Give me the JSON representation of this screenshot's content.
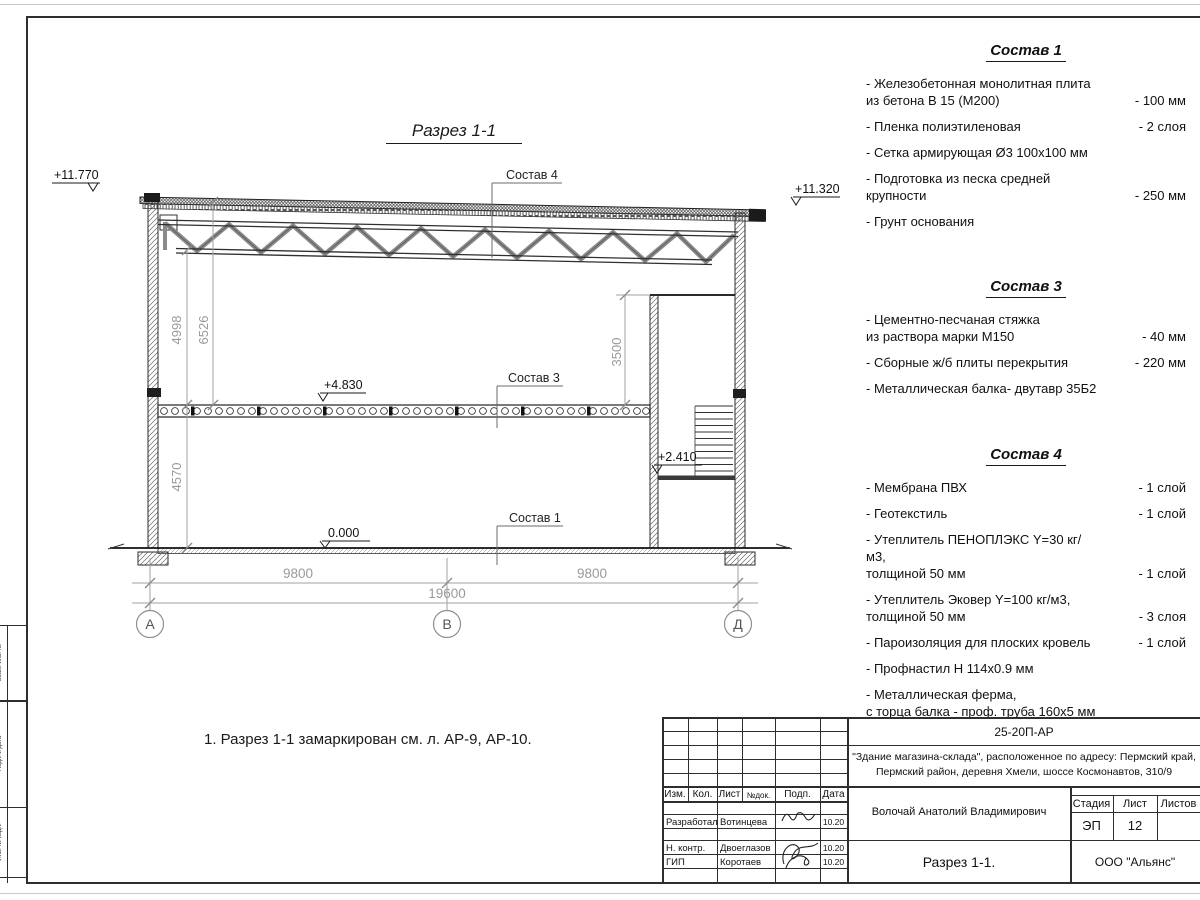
{
  "drawing": {
    "title": "Разрез 1-1",
    "note": "1. Разрез 1-1 замаркирован см. л. АР-9, АР-10.",
    "elevations": {
      "roof_left": "+11.770",
      "roof_right": "+11.320",
      "floor2": "+4.830",
      "ground": "0.000",
      "landing": "+2.410"
    },
    "dims": {
      "truss_clear": "4998",
      "roof_clear": "6526",
      "ground_clear": "4570",
      "room_height": "3500",
      "span_left": "9800",
      "span_right": "9800",
      "span_total": "19600"
    },
    "axes": {
      "a": "А",
      "b": "В",
      "d": "Д"
    },
    "layer_refs": {
      "r4": "Состав 4",
      "r3": "Состав 3",
      "r1": "Состав 1"
    }
  },
  "comp1": {
    "title": "Состав 1",
    "items": [
      {
        "name": "- Железобетонная  монолитная плита\n  из бетона В 15 (М200)",
        "value": "- 100 мм"
      },
      {
        "name": "- Пленка полиэтиленовая",
        "value": "-  2 слоя"
      },
      {
        "name": "- Сетка армирующая Ø3 100х100 мм",
        "value": ""
      },
      {
        "name": "- Подготовка из песка средней\n  крупности",
        "value": "- 250 мм"
      },
      {
        "name": "- Грунт основания",
        "value": ""
      }
    ]
  },
  "comp3": {
    "title": "Состав 3",
    "items": [
      {
        "name": "- Цементно-песчаная стяжка\n  из раствора марки М150",
        "value": "- 40 мм"
      },
      {
        "name": "- Сборные ж/б плиты перекрытия",
        "value": "- 220 мм"
      },
      {
        "name": "- Металлическая балка- двутавр 35Б2",
        "value": ""
      }
    ]
  },
  "comp4": {
    "title": "Состав 4",
    "items": [
      {
        "name": "- Мембрана ПВХ",
        "value": "- 1 слой"
      },
      {
        "name": "- Геотекстиль",
        "value": "- 1 слой"
      },
      {
        "name": "- Утеплитель ПЕНОПЛЭКС Y=30 кг/м3,\n  толщиной 50 мм",
        "value": "- 1 слой"
      },
      {
        "name": "- Утеплитель Эковер Y=100 кг/м3,\n  толщиной 50 мм",
        "value": "- 3 слоя"
      },
      {
        "name": "- Пароизоляция для плоских кровель",
        "value": "- 1 слой"
      },
      {
        "name": "- Профнастил Н 114х0.9 мм",
        "value": ""
      },
      {
        "name": "- Металлическая ферма,\n  с торца балка - проф. труба 160х5 мм",
        "value": ""
      }
    ]
  },
  "titleblock": {
    "code": "25-20П-АР",
    "project_line1": "\"Здание магазина-склада\", расположенное по адресу: Пермский край,",
    "project_line2": "Пермский район, деревня Хмели, шоссе Космонавтов, 310/9",
    "cols": {
      "izm": "Изм.",
      "kol": "Кол.",
      "list": "Лист",
      "ndok": "№док.",
      "podp": "Подп.",
      "data": "Дата"
    },
    "rows": [
      {
        "role": "Разработал",
        "name": "Вотинцева",
        "date": "10.20"
      },
      {
        "role": "Н. контр.",
        "name": "Двоеглазов",
        "date": "10.20"
      },
      {
        "role": "ГИП",
        "name": "Коротаев",
        "date": "10.20"
      }
    ],
    "chief": "Волочай Анатолий Владимирович",
    "stage_label": "Стадия",
    "sheet_label": "Лист",
    "sheets_label": "Листов",
    "stage": "ЭП",
    "sheet_no": "12",
    "sheets_total": "",
    "sheet_title": "Разрез 1-1.",
    "company": "ООО \"Альянс\""
  },
  "stamp_left": {
    "c1": "Взам. инв. №",
    "c2": "Подп. и дата",
    "c3": "Инв. № подл."
  }
}
